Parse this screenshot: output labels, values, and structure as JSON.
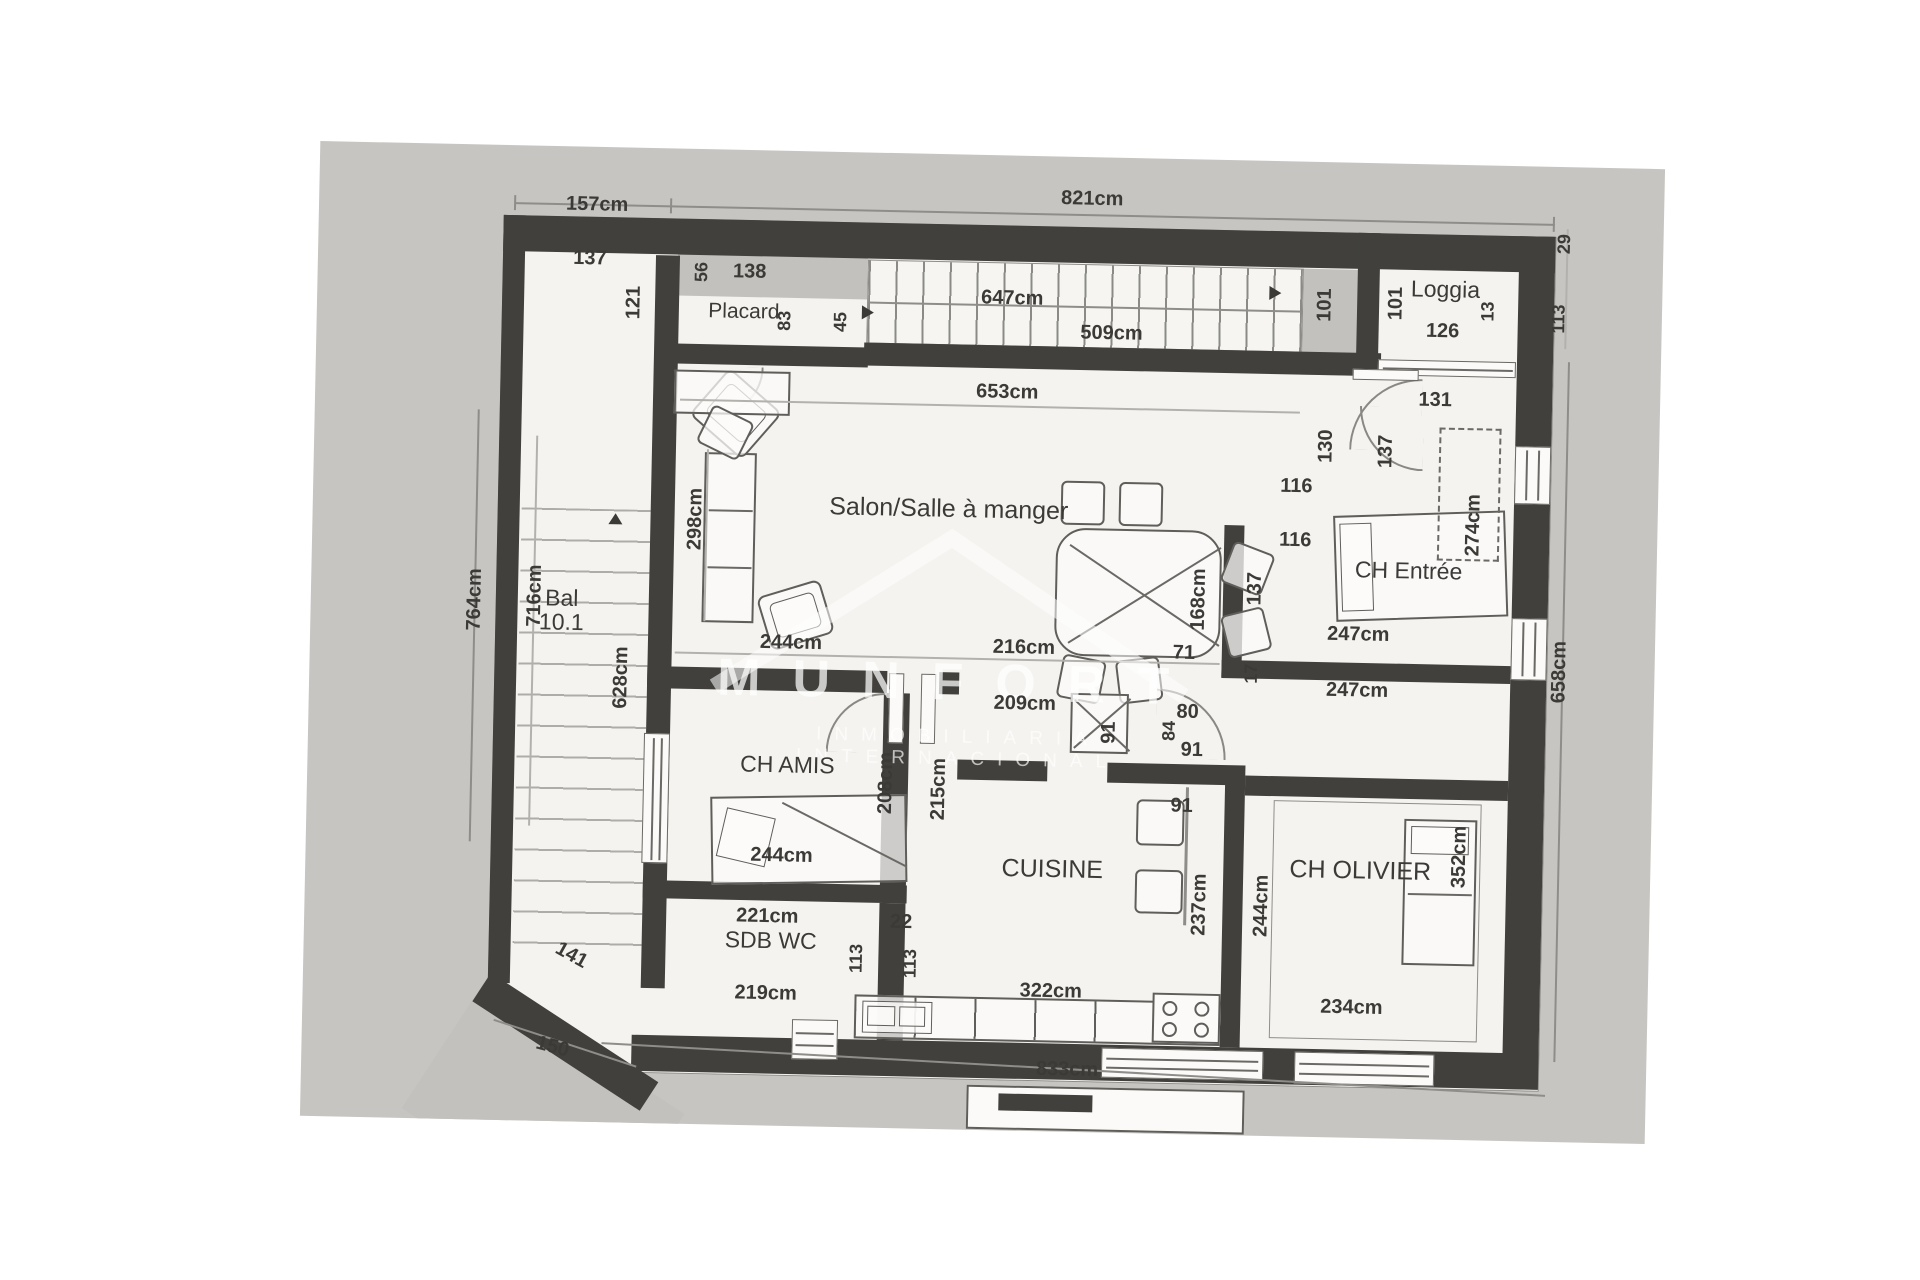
{
  "watermark": {
    "line1": "MUNFORT",
    "line2": "INMOBILIARIA INTERNACIONAL"
  },
  "colors": {
    "wall": "#41403d",
    "scan_bg": "#c7c5c1",
    "room_bg": "#f4f3f0",
    "text": "#3b3a37",
    "watermark": "#ffffff"
  },
  "plan": {
    "rooms": [
      "Salon/Salle à manger",
      "CH Entrée",
      "CH AMIS",
      "CUISINE",
      "SDB WC",
      "CH OLIVIER",
      "Loggia",
      "Placard",
      "Bal"
    ],
    "labels": [
      {
        "t": "157cm",
        "x": 278,
        "y": 58
      },
      {
        "t": "821cm",
        "x": 773,
        "y": 42
      },
      {
        "t": "137",
        "x": 272,
        "y": 112
      },
      {
        "t": "121",
        "x": 317,
        "y": 155,
        "r": -90
      },
      {
        "t": "56",
        "x": 384,
        "y": 123,
        "r": -90,
        "s": 18
      },
      {
        "t": "138",
        "x": 432,
        "y": 122
      },
      {
        "t": "647cm",
        "x": 695,
        "y": 143
      },
      {
        "t": "45",
        "x": 524,
        "y": 170,
        "r": -90,
        "s": 18
      },
      {
        "t": "509cm",
        "x": 795,
        "y": 176
      },
      {
        "t": "101",
        "x": 1008,
        "y": 143,
        "r": -90
      },
      {
        "t": "101",
        "x": 1079,
        "y": 140,
        "r": -90
      },
      {
        "t": "Loggia",
        "x": 1128,
        "y": 125,
        "room": 1
      },
      {
        "t": "13",
        "x": 1171,
        "y": 146,
        "r": -90,
        "s": 18
      },
      {
        "t": "126",
        "x": 1126,
        "y": 167
      },
      {
        "t": "29",
        "x": 1246,
        "y": 77,
        "r": -90,
        "s": 18
      },
      {
        "t": "113",
        "x": 1242,
        "y": 152,
        "r": -90,
        "s": 18
      },
      {
        "t": "Placard",
        "x": 427,
        "y": 162,
        "room": 1,
        "s": 21
      },
      {
        "t": "83",
        "x": 468,
        "y": 170,
        "r": -90,
        "s": 18
      },
      {
        "t": "653cm",
        "x": 692,
        "y": 237
      },
      {
        "t": "131",
        "x": 1120,
        "y": 236
      },
      {
        "t": "137",
        "x": 1072,
        "y": 288,
        "r": -90
      },
      {
        "t": "130",
        "x": 1012,
        "y": 284,
        "r": -90
      },
      {
        "t": "116",
        "x": 983,
        "y": 325
      },
      {
        "t": "116",
        "x": 983,
        "y": 379
      },
      {
        "t": "274cm",
        "x": 1161,
        "y": 360,
        "r": -90
      },
      {
        "t": "CH Entrée",
        "x": 1097,
        "y": 407,
        "room": 1
      },
      {
        "t": "247cm",
        "x": 1048,
        "y": 472
      },
      {
        "t": "247cm",
        "x": 1048,
        "y": 528
      },
      {
        "t": "137",
        "x": 944,
        "y": 428,
        "r": -90
      },
      {
        "t": "168cm",
        "x": 888,
        "y": 440,
        "r": -90
      },
      {
        "t": "71",
        "x": 874,
        "y": 494
      },
      {
        "t": "17",
        "x": 942,
        "y": 513,
        "r": -90,
        "s": 18
      },
      {
        "t": "298cm",
        "x": 383,
        "y": 370,
        "r": -90
      },
      {
        "t": "Salon/Salle à manger",
        "x": 636,
        "y": 355,
        "room": 1,
        "s": 25
      },
      {
        "t": "764cm",
        "x": 164,
        "y": 455,
        "r": -90
      },
      {
        "t": "716cm",
        "x": 224,
        "y": 450,
        "r": -90
      },
      {
        "t": "Bal",
        "x": 251,
        "y": 452,
        "room": 1
      },
      {
        "t": "10.1",
        "x": 251,
        "y": 476,
        "room": 1
      },
      {
        "t": "628cm",
        "x": 312,
        "y": 530,
        "r": -90
      },
      {
        "t": "244cm",
        "x": 481,
        "y": 492
      },
      {
        "t": "216cm",
        "x": 714,
        "y": 492
      },
      {
        "t": "209cm",
        "x": 716,
        "y": 548
      },
      {
        "t": "91",
        "x": 801,
        "y": 575,
        "r": -90
      },
      {
        "t": "80",
        "x": 879,
        "y": 553
      },
      {
        "t": "84",
        "x": 861,
        "y": 572,
        "r": -90,
        "s": 18
      },
      {
        "t": "91",
        "x": 884,
        "y": 591
      },
      {
        "t": "658cm",
        "x": 1250,
        "y": 505,
        "r": -90
      },
      {
        "t": "CH AMIS",
        "x": 480,
        "y": 614,
        "room": 1
      },
      {
        "t": "208cm",
        "x": 579,
        "y": 630,
        "r": -90
      },
      {
        "t": "215cm",
        "x": 632,
        "y": 635,
        "r": -90
      },
      {
        "t": "244cm",
        "x": 476,
        "y": 705
      },
      {
        "t": "91",
        "x": 875,
        "y": 647
      },
      {
        "t": "CUISINE",
        "x": 747,
        "y": 713,
        "room": 1,
        "s": 25
      },
      {
        "t": "237cm",
        "x": 895,
        "y": 745,
        "r": -90
      },
      {
        "t": "244cm",
        "x": 957,
        "y": 745,
        "r": -90
      },
      {
        "t": "CH OLIVIER",
        "x": 1055,
        "y": 708,
        "room": 1,
        "s": 25
      },
      {
        "t": "352cm",
        "x": 1154,
        "y": 692,
        "r": -90
      },
      {
        "t": "221cm",
        "x": 463,
        "y": 766
      },
      {
        "t": "SDB WC",
        "x": 467,
        "y": 790,
        "room": 1
      },
      {
        "t": "113",
        "x": 553,
        "y": 806,
        "r": -90,
        "s": 18
      },
      {
        "t": "22",
        "x": 597,
        "y": 769
      },
      {
        "t": "113",
        "x": 607,
        "y": 810,
        "r": -90,
        "s": 18
      },
      {
        "t": "219cm",
        "x": 463,
        "y": 843
      },
      {
        "t": "141",
        "x": 268,
        "y": 809,
        "r": 28
      },
      {
        "t": "150",
        "x": 251,
        "y": 901,
        "r": 14
      },
      {
        "t": "322cm",
        "x": 748,
        "y": 835
      },
      {
        "t": "234cm",
        "x": 1049,
        "y": 845
      },
      {
        "t": "833cm",
        "x": 766,
        "y": 913
      }
    ]
  }
}
